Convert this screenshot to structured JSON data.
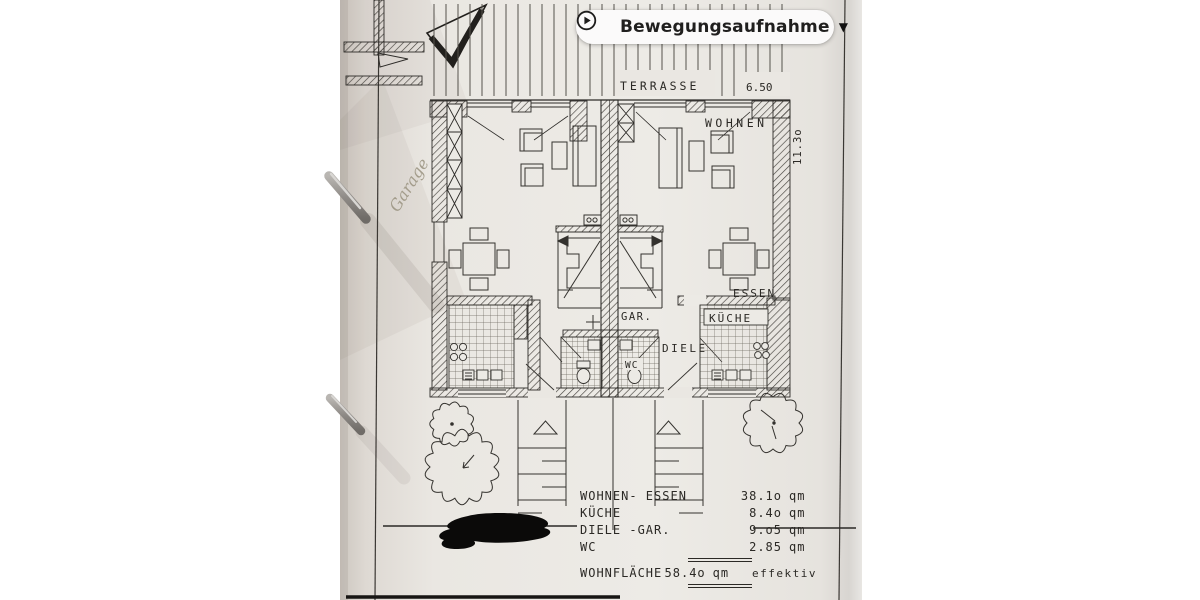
{
  "overlay": {
    "pill": {
      "label": "Bewegungsaufnahme"
    }
  },
  "plan": {
    "labels": {
      "terrasse": "TERRASSE",
      "terrasse_dim": "6.50",
      "wohnen": "WOHNEN",
      "essen": "ESSEN",
      "kueche": "KÜCHE",
      "gar": "GAR.",
      "diele": "DIELE",
      "wc": "WC",
      "depth_dim": "11.3o",
      "handwritten_note": "Garage"
    },
    "area_table": {
      "rows": [
        {
          "label": "WOHNEN- ESSEN",
          "value": "38.1o",
          "unit": "qm"
        },
        {
          "label": "KÜCHE",
          "value": "8.4o",
          "unit": "qm"
        },
        {
          "label": "DIELE -GAR.",
          "value": "9.o5",
          "unit": "qm"
        },
        {
          "label": "WC",
          "value": "2.85",
          "unit": "qm"
        }
      ],
      "total": {
        "label": "WOHNFLÄCHE",
        "value": "58.4o",
        "unit": "qm",
        "suffix": "effektiv"
      }
    }
  }
}
